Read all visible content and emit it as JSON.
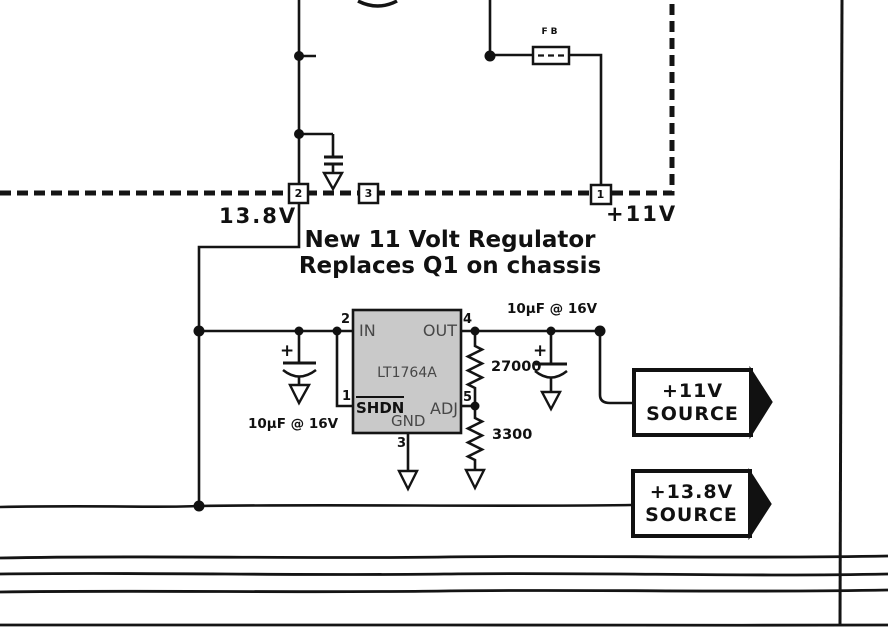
{
  "diagram": {
    "note": {
      "line1": "New 11 Volt Regulator",
      "line2": "Replaces Q1 on chassis"
    },
    "nets": {
      "v138_label": "13.8V",
      "v11_label": "+11V"
    },
    "connectors": {
      "c2": "2",
      "c3": "3",
      "c1": "1"
    },
    "ferrite_bead_label": "FB",
    "ic": {
      "part_number": "LT1764A",
      "pin_in": {
        "num": "2",
        "label": "IN"
      },
      "pin_out": {
        "num": "4",
        "label": "OUT"
      },
      "pin_shdn": {
        "num": "1",
        "label": "SHDN"
      },
      "pin_adj": {
        "num": "5",
        "label": "ADJ"
      },
      "pin_gnd": {
        "num": "3",
        "label": "GND"
      }
    },
    "input_cap": {
      "value": "10µF @ 16V",
      "plus": "+"
    },
    "output_cap": {
      "value": "10µF @ 16V",
      "plus": "+"
    },
    "r_top": "27000",
    "r_bottom": "3300",
    "source_11v": {
      "line1": "+11V",
      "line2": "SOURCE"
    },
    "source_138v": {
      "line1": "+13.8V",
      "line2": "SOURCE"
    }
  }
}
